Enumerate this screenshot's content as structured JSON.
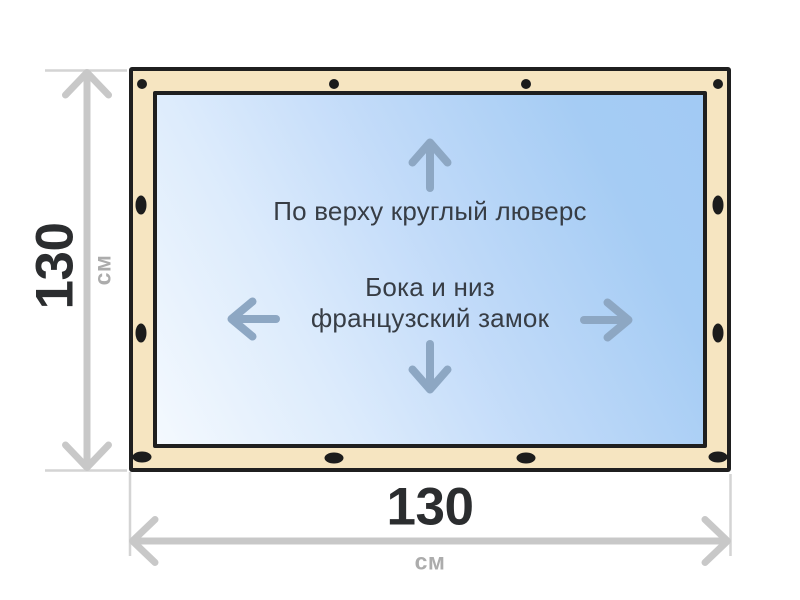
{
  "diagram": {
    "type": "product-spec-drawing",
    "panel": {
      "top_label": "По верху круглый люверс",
      "side_label_line1": "Бока и низ",
      "side_label_line2": "французский замок"
    },
    "dimensions": {
      "height": {
        "value": "130",
        "unit": "см"
      },
      "width": {
        "value": "130",
        "unit": "см"
      }
    },
    "icons": {
      "arrows": [
        "arrow-up-icon",
        "arrow-down-icon",
        "arrow-left-icon",
        "arrow-right-icon"
      ],
      "grommet": "grommet-dot",
      "dimension_arrows": [
        "height-dimension-arrow",
        "width-dimension-arrow"
      ]
    },
    "colors": {
      "background": "#ffffff",
      "frame_fill": "#f6e5c1",
      "frame_border": "#1f1f1f",
      "panel_gradient_light": "#f4f9fe",
      "panel_gradient_dark": "#a2caf4",
      "grommet": "#1c1c1c",
      "direction_arrow": "#8da7c3",
      "label_text": "#373d45",
      "dimension_line": "#c8c8c8",
      "extension_line": "#d4d4d4",
      "dimension_value_text": "#2b2d2f",
      "dimension_unit_text": "#acacac"
    }
  }
}
